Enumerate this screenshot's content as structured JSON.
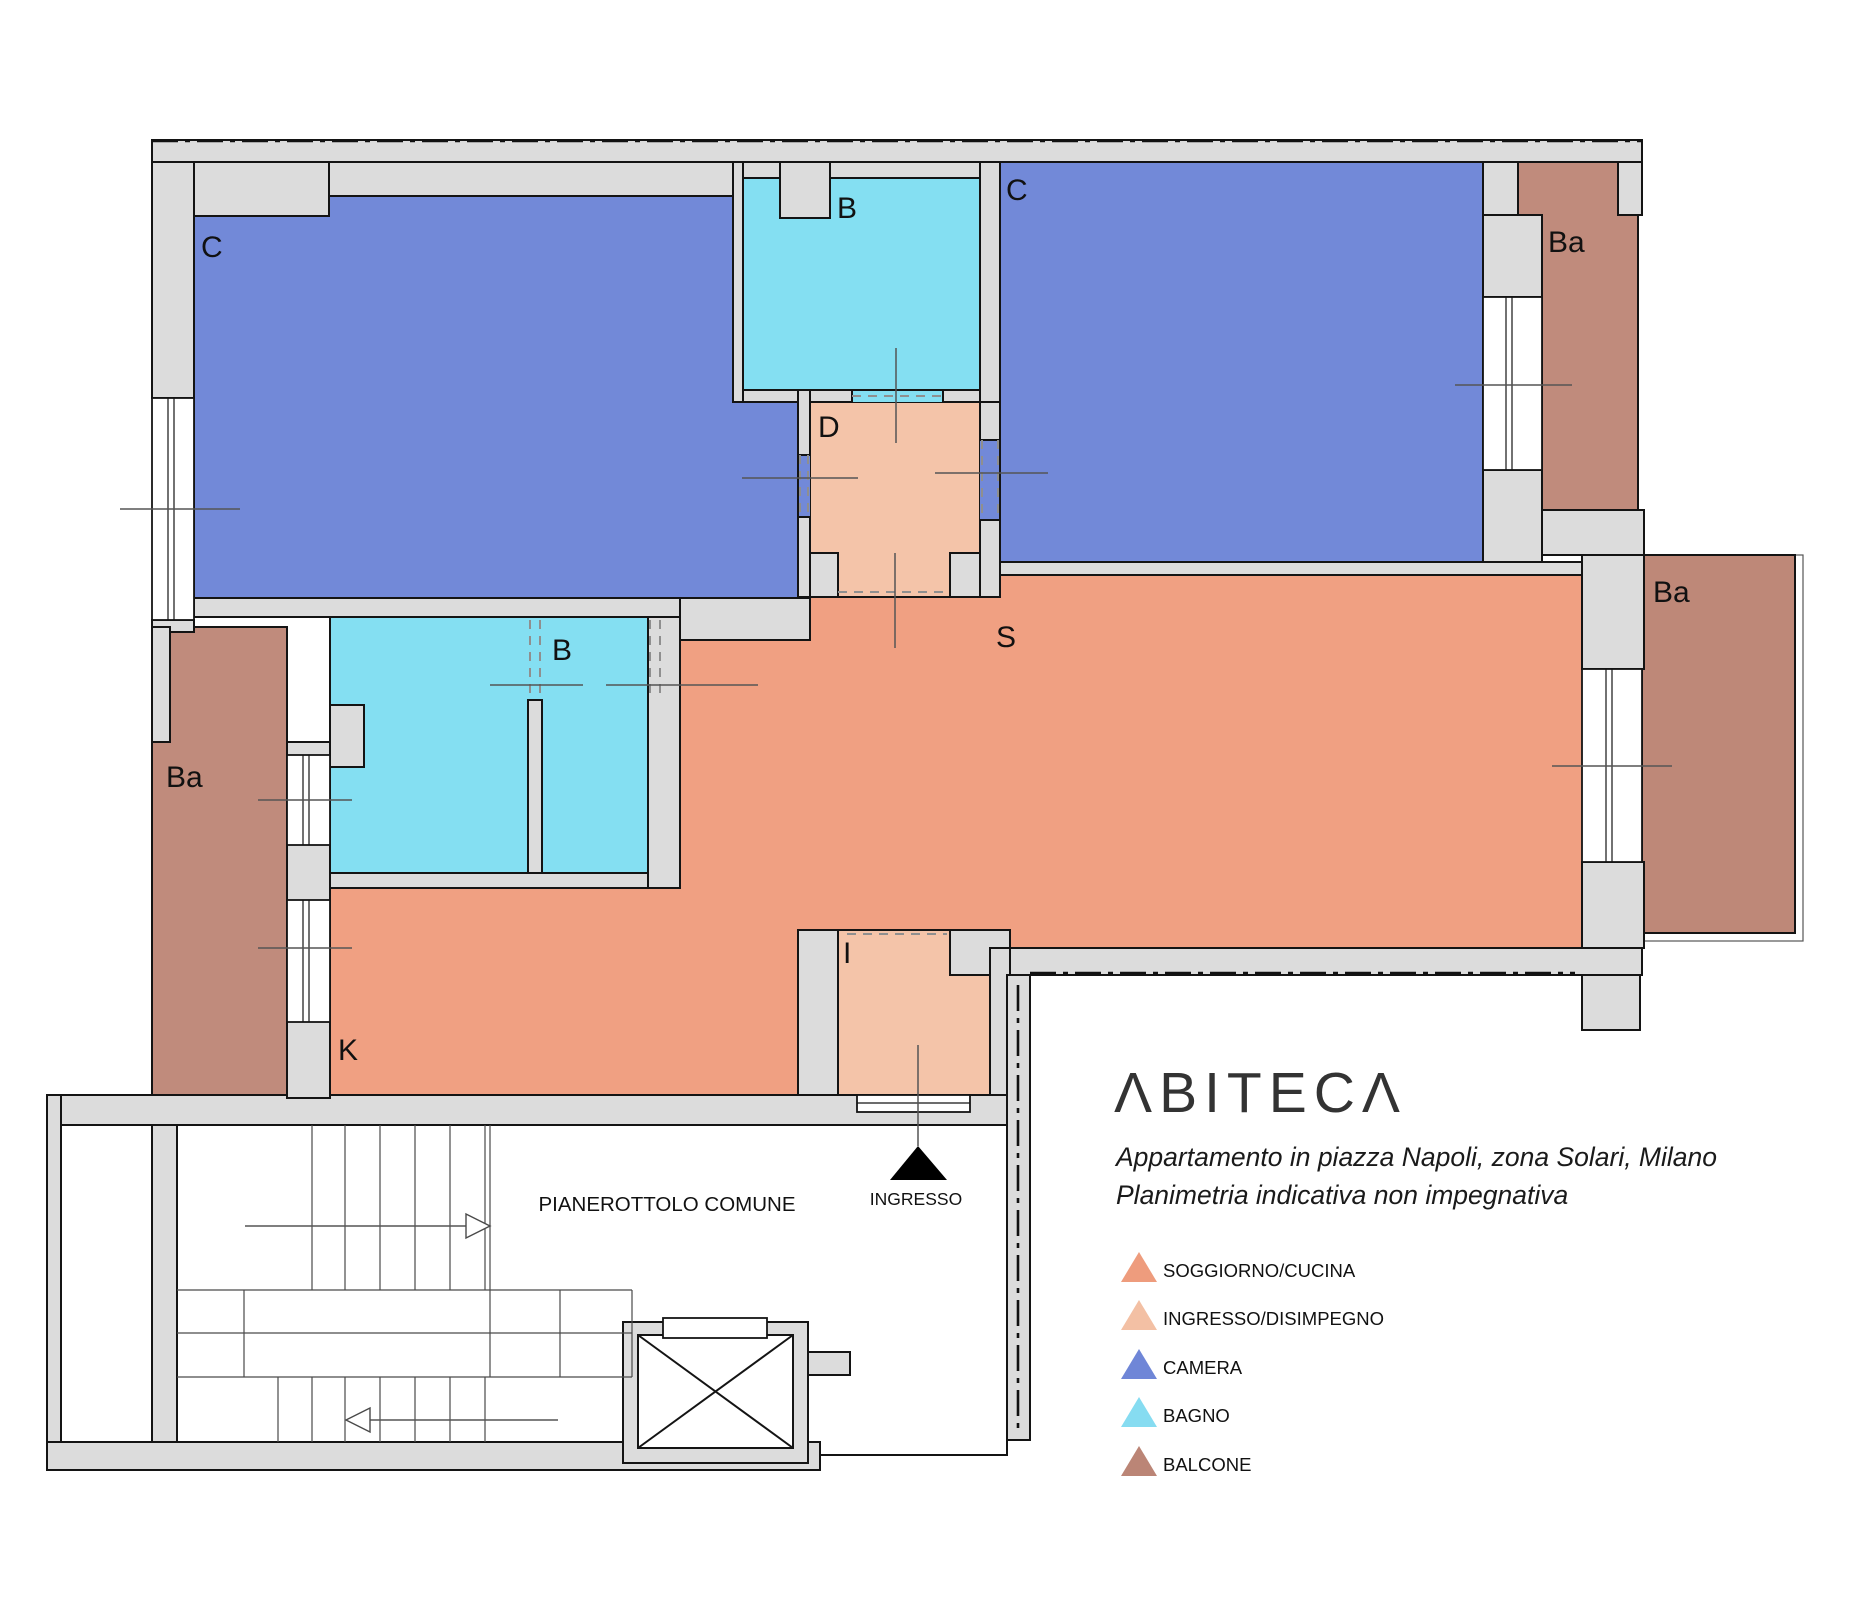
{
  "branding": {
    "logo": "ΛBITECΛ",
    "caption_line1": "Appartamento in piazza Napoli, zona Solari, Milano",
    "caption_line2": "Planimetria indicativa non impegnativa"
  },
  "floorplan": {
    "rooms": {
      "camera_1": {
        "label": "C",
        "type": "camera"
      },
      "bagno_1": {
        "label": "B",
        "type": "bagno"
      },
      "camera_2": {
        "label": "C",
        "type": "camera"
      },
      "disimpegno": {
        "label": "D",
        "type": "ingresso_disimpegno"
      },
      "balcone_top_right": {
        "label": "Ba",
        "type": "balcone"
      },
      "balcone_right": {
        "label": "Ba",
        "type": "balcone"
      },
      "bagno_2": {
        "label": "B",
        "type": "bagno"
      },
      "soggiorno": {
        "label": "S",
        "type": "soggiorno_cucina"
      },
      "balcone_left": {
        "label": "Ba",
        "type": "balcone"
      },
      "cucina": {
        "label": "K",
        "type": "soggiorno_cucina"
      },
      "ingresso": {
        "label": "I",
        "type": "ingresso_disimpegno"
      }
    },
    "common_areas": {
      "pianerottolo": "PIANEROTTOLO COMUNE",
      "entrance_marker": "INGRESSO"
    },
    "colors": {
      "camera": "#7289D8",
      "bagno": "#84DFF2",
      "soggiorno": "#F0A082",
      "ingresso": "#F4C4A9",
      "balcone": "#C08B7C",
      "balcone_deep": "#BE8878",
      "wall": "#DCDCDC"
    }
  },
  "legend": {
    "items": [
      {
        "label": "SOGGIORNO/CUCINA",
        "color": "#EE9C7D"
      },
      {
        "label": "INGRESSO/DISIMPEGNO",
        "color": "#F3C0A4"
      },
      {
        "label": "CAMERA",
        "color": "#6F86D7"
      },
      {
        "label": "BAGNO",
        "color": "#86DCF1"
      },
      {
        "label": "BALCONE",
        "color": "#BB8576"
      }
    ]
  }
}
